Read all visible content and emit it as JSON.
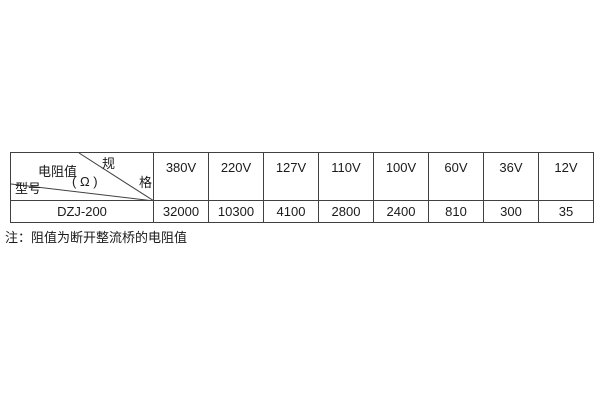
{
  "table": {
    "corner": {
      "spec_char_top": "规",
      "spec_char_bottom": "格",
      "resistance_label": "电阻值",
      "resistance_unit": "( Ω )",
      "model_label": "型号"
    },
    "columns": [
      "380V",
      "220V",
      "127V",
      "110V",
      "100V",
      "60V",
      "36V",
      "12V"
    ],
    "row": {
      "model": "DZJ-200",
      "values": [
        "32000",
        "10300",
        "4100",
        "2800",
        "2400",
        "810",
        "300",
        "35"
      ]
    }
  },
  "note": "注：阻值为断开整流桥的电阻值",
  "colors": {
    "border": "#404040",
    "text": "#1a1a1a",
    "background": "#ffffff"
  }
}
